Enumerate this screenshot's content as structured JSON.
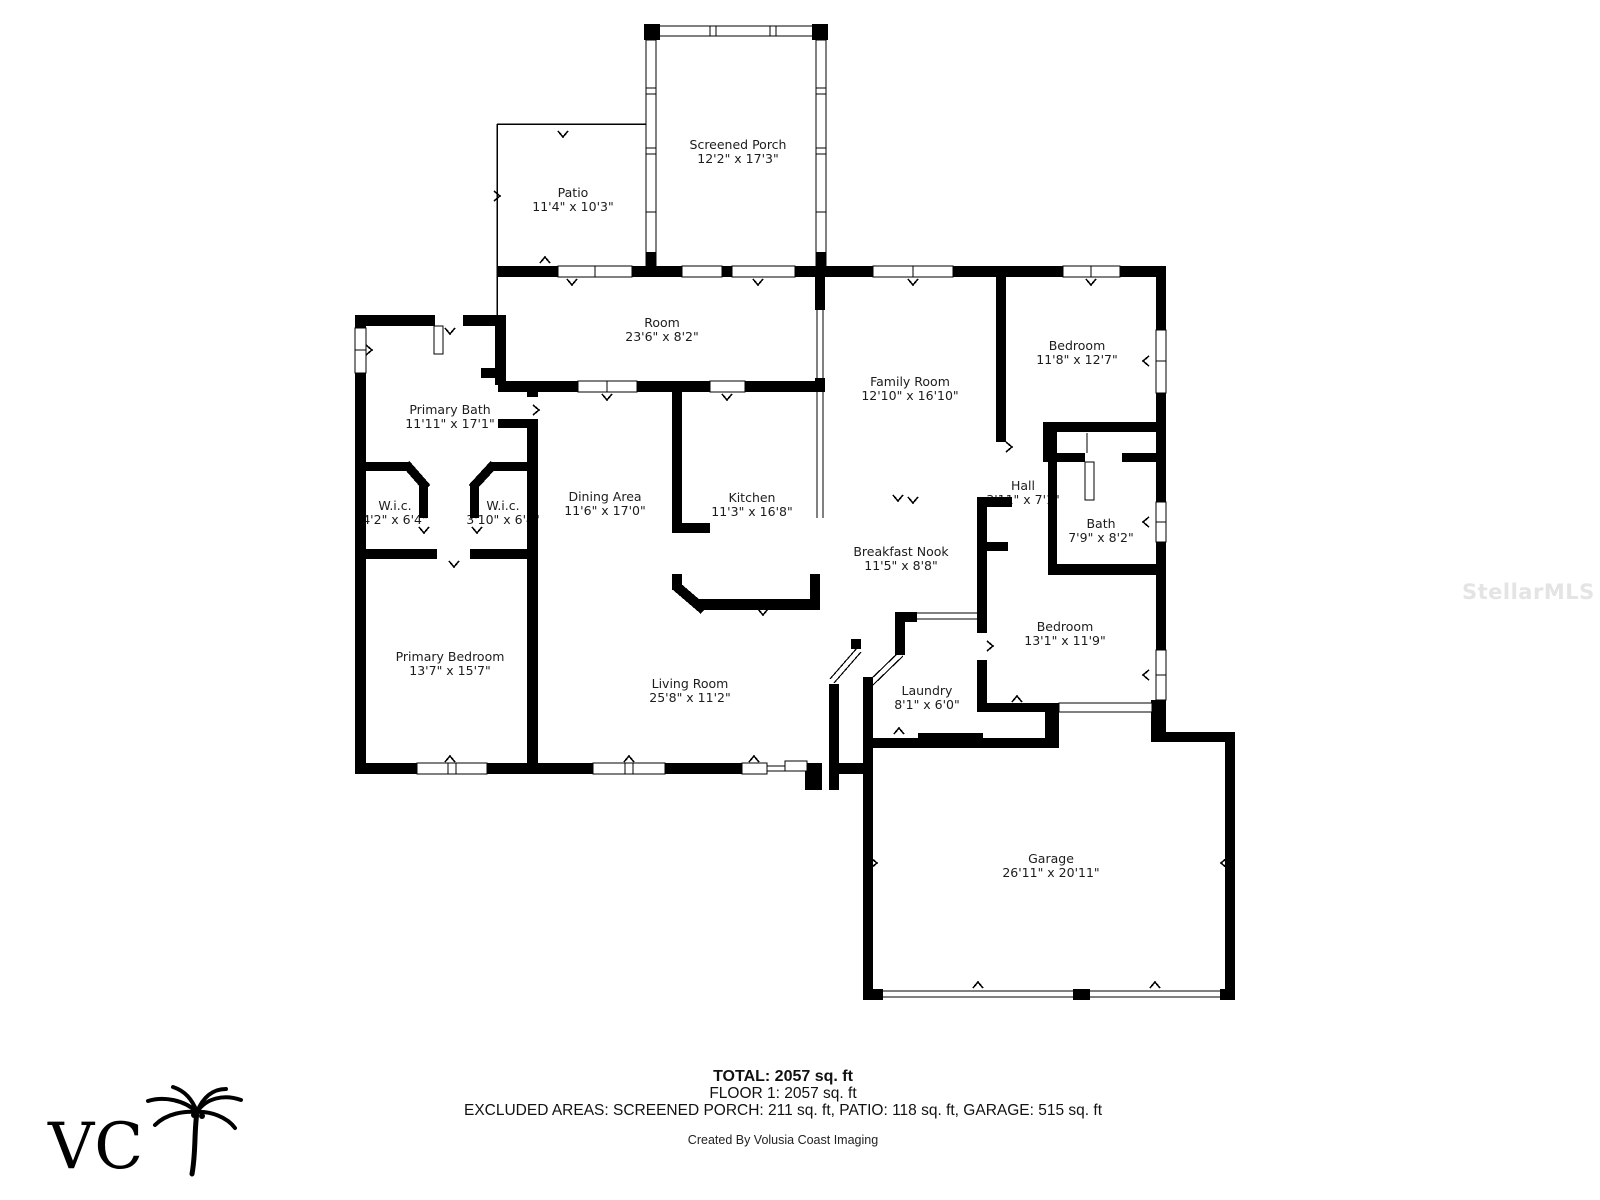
{
  "watermark": "StellarMLS",
  "logo": {
    "letters": "VC",
    "icon": "palm-tree"
  },
  "rooms": [
    {
      "name": "Screened Porch",
      "dims": "12'2\" x 17'3\""
    },
    {
      "name": "Patio",
      "dims": "11'4\" x 10'3\""
    },
    {
      "name": "Room",
      "dims": "23'6\" x 8'2\""
    },
    {
      "name": "Family Room",
      "dims": "12'10\" x 16'10\""
    },
    {
      "name": "Bedroom",
      "dims": "11'8\" x 12'7\""
    },
    {
      "name": "Primary Bath",
      "dims": "11'11\" x 17'1\""
    },
    {
      "name": "W.i.c.",
      "dims": "4'2\" x 6'4\""
    },
    {
      "name": "W.i.c.",
      "dims": "3'10\" x 6'4\""
    },
    {
      "name": "Dining Area",
      "dims": "11'6\" x 17'0\""
    },
    {
      "name": "Kitchen",
      "dims": "11'3\" x 16'8\""
    },
    {
      "name": "Hall",
      "dims": "3'11\" x 7'1\""
    },
    {
      "name": "Bath",
      "dims": "7'9\" x 8'2\""
    },
    {
      "name": "Breakfast Nook",
      "dims": "11'5\" x 8'8\""
    },
    {
      "name": "Bedroom",
      "dims": "13'1\" x 11'9\""
    },
    {
      "name": "Primary Bedroom",
      "dims": "13'7\" x 15'7\""
    },
    {
      "name": "Living Room",
      "dims": "25'8\" x 11'2\""
    },
    {
      "name": "Laundry",
      "dims": "8'1\" x 6'0\""
    },
    {
      "name": "Garage",
      "dims": "26'11\" x 20'11\""
    }
  ],
  "summary": {
    "total": "TOTAL: 2057 sq. ft",
    "floor": "FLOOR 1: 2057 sq. ft",
    "excluded": "EXCLUDED AREAS: SCREENED PORCH: 211 sq. ft, PATIO: 118 sq. ft, GARAGE: 515 sq. ft",
    "credit": "Created By Volusia Coast Imaging"
  }
}
